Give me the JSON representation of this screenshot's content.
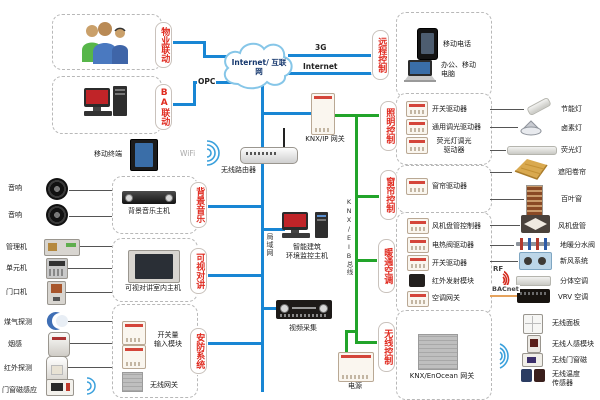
{
  "cloud": {
    "label": "Internet/ 互联网"
  },
  "net_labels": {
    "g3": "3G",
    "internet": "Internet",
    "opc": "OPC",
    "wifi": "WiFi",
    "lan": "局域网",
    "knx_bus": "KNX/EIB总线",
    "rf": "RF",
    "bacnet": "BACnet"
  },
  "tabs": {
    "property": "物业联动",
    "ba": "BA联动",
    "remote": "远程控制",
    "lighting": "照明控制",
    "curtain": "窗帘控制",
    "hvac": "暖通空调",
    "wireless": "无线控制",
    "music": "背景音乐",
    "intercom": "可视对讲",
    "security": "安防系统"
  },
  "center": {
    "mobile_terminal": "移动终端",
    "router": "无线路由器",
    "knx_ip_gateway": "KNX/IP 网关",
    "monitor_host": "智能建筑\n环境监控主机",
    "video_capture": "视频采集",
    "power": "电源"
  },
  "remote": {
    "phone": "移动电话",
    "laptop": "办公、移动\n电脑"
  },
  "music": {
    "host": "背景音乐主机",
    "speaker1": "音响",
    "speaker2": "音响"
  },
  "intercom": {
    "host": "可视对讲室内主机",
    "manager": "管理机",
    "unit": "单元机",
    "door": "门口机"
  },
  "security": {
    "input_module": "开关量\n输入模块",
    "wireless_gateway": "无线网关",
    "gas": "煤气探测",
    "smoke": "烟感",
    "infrared": "红外探测",
    "door_magnet": "门窗磁感应"
  },
  "lighting": {
    "switch_actuator": "开关驱动器",
    "dimmer": "通用调光驱动器",
    "fl_dimmer": "荧光灯调光\n驱动器",
    "cfl": "节能灯",
    "halogen": "卤素灯",
    "fluorescent": "荧光灯"
  },
  "curtain": {
    "actuator": "窗帘驱动器",
    "shade": "遮阳卷帘",
    "blind": "百叶窗"
  },
  "hvac": {
    "fan_coil_ctrl": "风机盘管控制器",
    "valve_actuator": "电热阀驱动器",
    "switch_actuator": "开关驱动器",
    "ir_module": "红外发射模块",
    "ac_gateway": "空调网关",
    "fan_coil": "风机盘管",
    "manifold": "地暖分水阀",
    "fresh_air": "新风系统",
    "split_ac": "分体空调",
    "vrv": "VRV 空调"
  },
  "wireless": {
    "gateway": "KNX/EnOcean 网关",
    "panel": "无线面板",
    "motion": "无线人感模块",
    "door_magnet": "无线门窗磁",
    "temp_sensor": "无线温度\n传感器"
  },
  "colors": {
    "lan": "#1886d4",
    "knx": "#22a42a",
    "bacnet": "#e5a25c",
    "tab_text": "#e02b20"
  }
}
